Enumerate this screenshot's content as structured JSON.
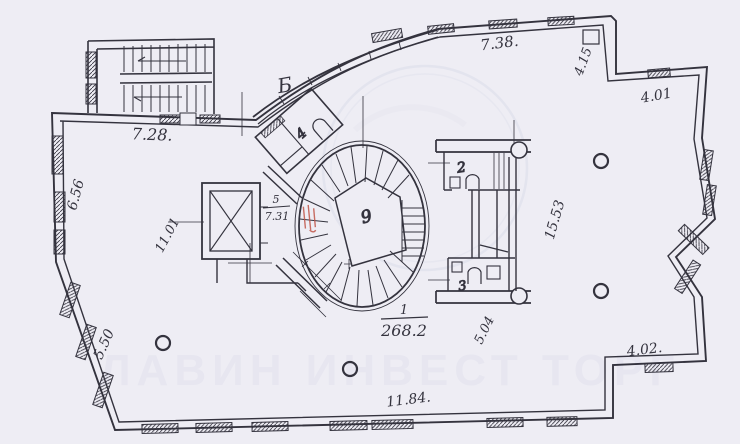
{
  "document": {
    "type": "scanned-floor-plan"
  },
  "colors": {
    "paper": "#eeedf4",
    "ink": "#34333e",
    "red_mark": "#c05548",
    "watermark": "#c9cce0"
  },
  "watermark": {
    "text": "ЛАВИН ИНВЕСТ ТОРГ"
  },
  "labels": {
    "dim_top_left_wall": "7.28.",
    "dim_top_wall": "7.38.",
    "dim_top_right_diag": "4.15",
    "dim_right_upper": "4.01",
    "dim_left_wall": "6.56",
    "dim_left_inner": "11.01",
    "dim_bottom_left_diag": "5.50",
    "dim_bottom_wall": "11.84.",
    "dim_bottom_right": "4.02.",
    "dim_right_diag": "15.53",
    "dim_right_lower_diag": "5.04",
    "axis_letter": "Б",
    "stair_core_label": "9",
    "room1_number": "1",
    "room1_area": "268.2",
    "room2_number": "2",
    "room3_number": "3",
    "room4_number": "4",
    "room5_number": "5",
    "room5_area": "7.31"
  }
}
